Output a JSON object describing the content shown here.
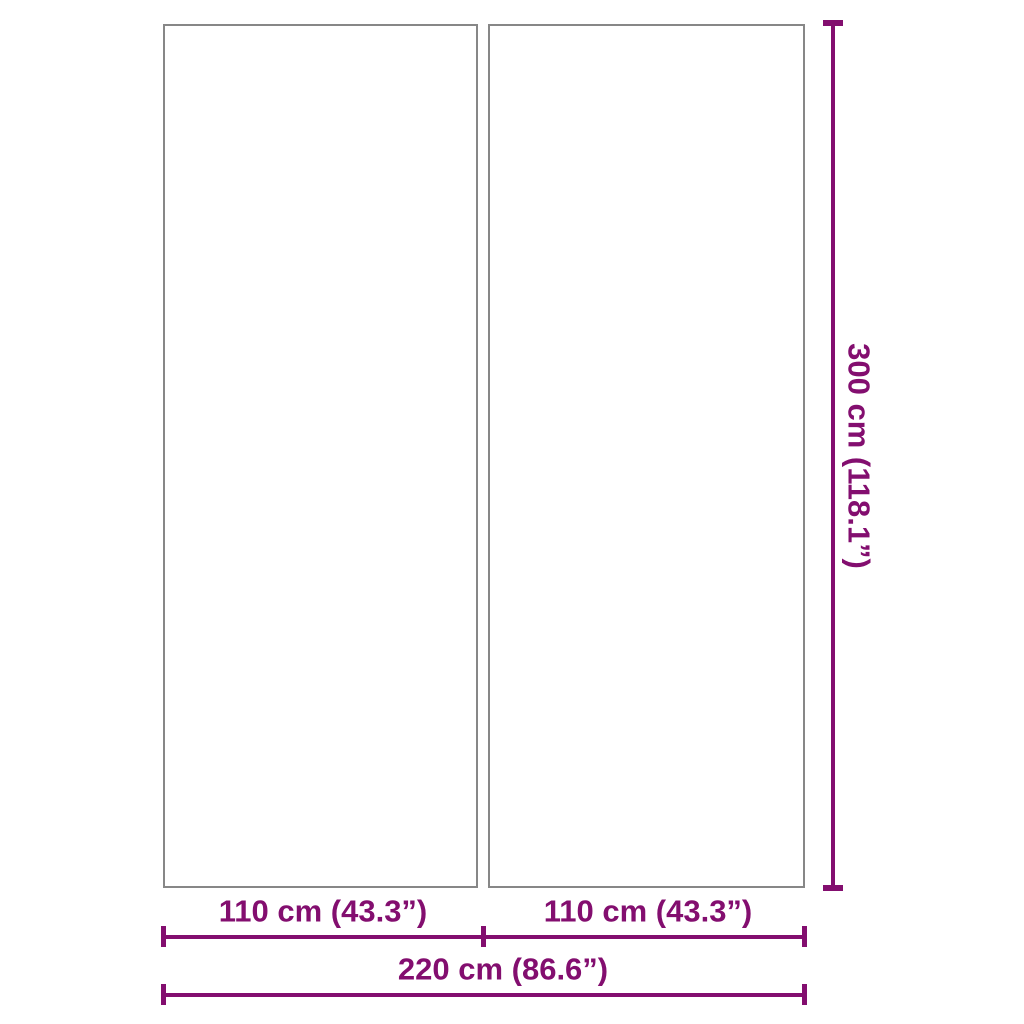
{
  "colors": {
    "dimension-color": "#830E6F",
    "panel-border-color": "#878787",
    "background": "#FFFFFF"
  },
  "diagram": {
    "type": "product-dimension-diagram",
    "panel_count": 2
  },
  "dimensions": {
    "left_width": "110 cm (43.3”)",
    "right_width": "110 cm (43.3”)",
    "total_width": "220 cm (86.6”)",
    "height": "300 cm (118.1”)"
  }
}
